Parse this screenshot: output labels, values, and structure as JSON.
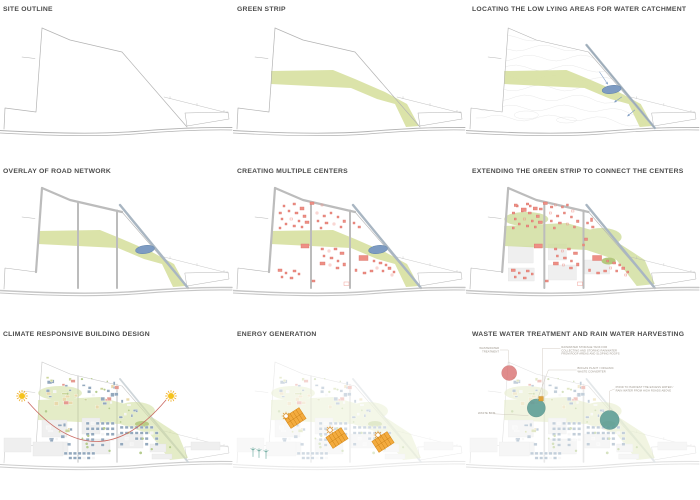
{
  "sheet": {
    "background": "#ffffff"
  },
  "colors": {
    "title_text": "#4b4b4b",
    "site_outline": "#b3b3b3",
    "road_gray": "#bcbcbc",
    "road_light": "#d6d6d6",
    "contour_gray": "#dedede",
    "green_strip": "#d9e2a4",
    "green_patch": "#cfdd9b",
    "green_pond": "#b4c87d",
    "water_blue": "#7d9bc2",
    "drain_blue": "#a9b6c2",
    "building_red": "#ee8f85",
    "masterplan_blue": "#93a8bd",
    "masterplan_beige": "#e9d9ab",
    "masterplan_olive": "#ccd59b",
    "masterplan_white": "#f4f4f4",
    "plot_gray": "#efefef",
    "sun_yellow": "#f5c31d",
    "sun_ray": "#eda617",
    "sun_path_red": "#c96a63",
    "solar_orange": "#f3ab3e",
    "solar_edge": "#d98c1e",
    "turbine_teal": "#4f9a8c",
    "treatment_red": "#d97070",
    "treatment_teal": "#579a93",
    "tank_orange": "#dfa33b",
    "annotation_text": "#9b948a",
    "annotation_line": "#c9c2b8"
  },
  "panels": [
    {
      "id": "site-outline",
      "title": "SITE OUTLINE"
    },
    {
      "id": "green-strip",
      "title": "GREEN STRIP"
    },
    {
      "id": "water-catchment",
      "title": "LOCATING THE LOW LYING AREAS FOR WATER CATCHMENT"
    },
    {
      "id": "road-network",
      "title": "OVERLAY OF ROAD NETWORK"
    },
    {
      "id": "multiple-centers",
      "title": "CREATING MULTIPLE CENTERS"
    },
    {
      "id": "extend-green",
      "title": "EXTENDING THE GREEN STRIP TO CONNECT THE CENTERS"
    },
    {
      "id": "climate-design",
      "title": "CLIMATE RESPONSIVE BUILDING DESIGN"
    },
    {
      "id": "energy-generation",
      "title": "ENERGY GENERATION"
    },
    {
      "id": "water-treatment",
      "title": "WASTE WATER TREATMENT AND RAIN WATER HARVESTING",
      "annotations": [
        {
          "id": "wastewater-treatment",
          "lines": [
            "WASTEWATER",
            "TREATMENT"
          ]
        },
        {
          "id": "rainwater-tank",
          "lines": [
            "RAINWATER STORAGE TANK FOR",
            "COLLECTING AND STORING RAINWATER",
            "FROM ROOF AREAS AND SLOPING ROOFS"
          ]
        },
        {
          "id": "biogas-plant",
          "lines": [
            "BIOGAS PLANT / ORGANIC",
            "WASTE CONVERTER"
          ]
        },
        {
          "id": "harvest-pond",
          "lines": [
            "POND TO HARVEST THE EXCESS WATER /",
            "RAIN WATER FROM HIGH ROADS ABOVE"
          ]
        },
        {
          "id": "waste-bins",
          "lines": [
            "WASTE BINS"
          ]
        }
      ]
    }
  ]
}
